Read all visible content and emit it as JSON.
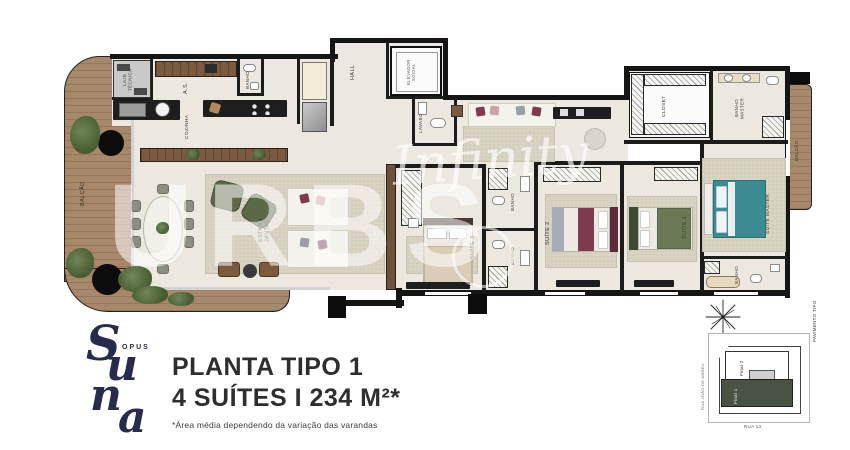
{
  "plan": {
    "labels": {
      "lajeTecnica": "LAJE TÉCNICA",
      "areaServico": "A.S.",
      "banhoCozinha": "BANHO",
      "cozinha": "COZINHA",
      "hall": "HALL",
      "elevador": "ELEVADOR SOCIAL",
      "lavabo": "LAVABO",
      "balcaoEsq": "BALCÃO",
      "estarJantar": "ESTAR | JANTAR",
      "suite3": "SUÍTE 3",
      "banhoSuite3": "BANHO",
      "banhoSuite2": "BANHO",
      "suite2": "SUÍTE 2",
      "suite1": "SUÍTE 1",
      "banhoSuite1": "BANHO",
      "closet": "CLOSET",
      "banhoMaster": "BANHO MASTER",
      "suiteMaster": "SUÍTE MASTER",
      "balcaoDir": "BALCÃO"
    }
  },
  "watermark": {
    "script": "Infinity",
    "brand": "URBS"
  },
  "logo": {
    "opus": "OPUS",
    "s": "S",
    "u": "u",
    "n": "n",
    "a": "a"
  },
  "title": {
    "line1": "PLANTA TIPO 1",
    "line2": "4 SUÍTES I 234 M²*",
    "footnote": "*Área média dependendo da variação das varandas"
  },
  "keymap": {
    "streetLeft": "RUA JOÃO DE ABREU",
    "streetBottom": "RUA 13",
    "pavement": "PAVIMENTO TIPO",
    "final1": "Final 1",
    "final2": "Final 2"
  },
  "colors": {
    "keymapHighlight": "#4a5244",
    "bedMaster": "#3d8b92",
    "bedSuite2": "#7e3a4e",
    "bedSuite1": "#6b7a55",
    "deckWood": "#a8886a",
    "logoNavy": "#272c4c"
  }
}
